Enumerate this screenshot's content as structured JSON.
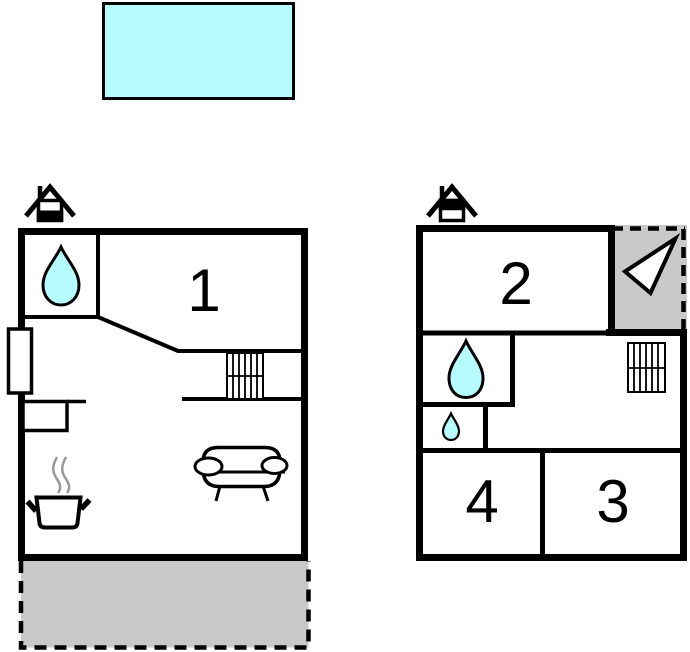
{
  "document": {
    "type": "floor-plan"
  },
  "colors": {
    "water": "#b6fcff",
    "area_gray": "#c9c9c9",
    "line": "#000000",
    "steam": "#999999"
  },
  "pool": {
    "icon": "swimming-pool"
  },
  "ground_floor": {
    "icon": "ground-floor-house-icon",
    "rooms": [
      {
        "label": "1"
      }
    ],
    "icons": [
      "waterdrop-icon",
      "window",
      "kitchen-counter",
      "cooking-pot-icon",
      "stairs-icon",
      "sofa-icon",
      "terrace"
    ]
  },
  "upper_floor": {
    "icon": "upper-floor-house-icon",
    "rooms": [
      {
        "label": "2"
      },
      {
        "label": "3"
      },
      {
        "label": "4"
      }
    ],
    "icons": [
      "waterdrop-large-icon",
      "waterdrop-small-icon",
      "stairs-icon",
      "entrance-arrow-icon",
      "balcony"
    ]
  }
}
